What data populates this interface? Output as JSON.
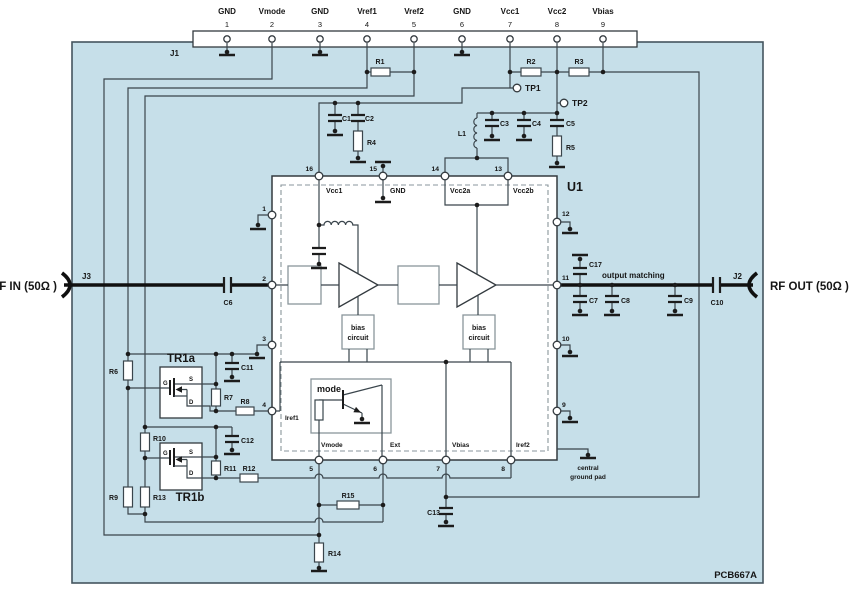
{
  "board": {
    "ref": "PCB667A"
  },
  "j1": {
    "ref": "J1",
    "pins": [
      {
        "num": "1",
        "name": "GND"
      },
      {
        "num": "2",
        "name": "Vmode"
      },
      {
        "num": "3",
        "name": "GND"
      },
      {
        "num": "4",
        "name": "Vref1"
      },
      {
        "num": "5",
        "name": "Vref2"
      },
      {
        "num": "6",
        "name": "GND"
      },
      {
        "num": "7",
        "name": "Vcc1"
      },
      {
        "num": "8",
        "name": "Vcc2"
      },
      {
        "num": "9",
        "name": "Vbias"
      }
    ]
  },
  "rf_in": {
    "ref": "J3",
    "label": "RF IN (50Ω )"
  },
  "rf_out": {
    "ref": "J2",
    "label": "RF OUT (50Ω )"
  },
  "tp1": "TP1",
  "tp2": "TP2",
  "u1": {
    "ref": "U1",
    "pin16_name": "Vcc1",
    "pin15_name": "GND",
    "pin14_name": "Vcc2a",
    "pin13_name": "Vcc2b",
    "nums": {
      "p1": "1",
      "p2": "2",
      "p3": "3",
      "p4": "4",
      "p5": "5",
      "p6": "6",
      "p7": "7",
      "p8": "8",
      "p9": "9",
      "p10": "10",
      "p11": "11",
      "p12": "12",
      "p13": "13",
      "p14": "14",
      "p15": "15",
      "p16": "16"
    },
    "iref1": "Iref1",
    "vmode": "Vmode",
    "ext": "Ext",
    "vbias": "Vbias",
    "iref2": "Iref2",
    "bias_line1": "bias",
    "bias_line2": "circuit",
    "mode": "mode",
    "central1": "central",
    "central2": "ground pad",
    "output_matching": "output matching"
  },
  "tr1a": {
    "ref": "TR1a",
    "g": "G",
    "s": "S",
    "d": "D"
  },
  "tr1b": {
    "ref": "TR1b",
    "g": "G",
    "s": "S",
    "d": "D"
  },
  "parts": {
    "r1": "R1",
    "r2": "R2",
    "r3": "R3",
    "r4": "R4",
    "r5": "R5",
    "r6": "R6",
    "r7": "R7",
    "r8": "R8",
    "r9": "R9",
    "r10": "R10",
    "r11": "R11",
    "r12": "R12",
    "r13": "R13",
    "r14": "R14",
    "r15": "R15",
    "c1": "C1",
    "c2": "C2",
    "c3": "C3",
    "c4": "C4",
    "c5": "C5",
    "c6": "C6",
    "c7": "C7",
    "c8": "C8",
    "c9": "C9",
    "c10": "C10",
    "c11": "C11",
    "c12": "C12",
    "c13": "C13",
    "c17": "C17",
    "l1": "L1"
  }
}
